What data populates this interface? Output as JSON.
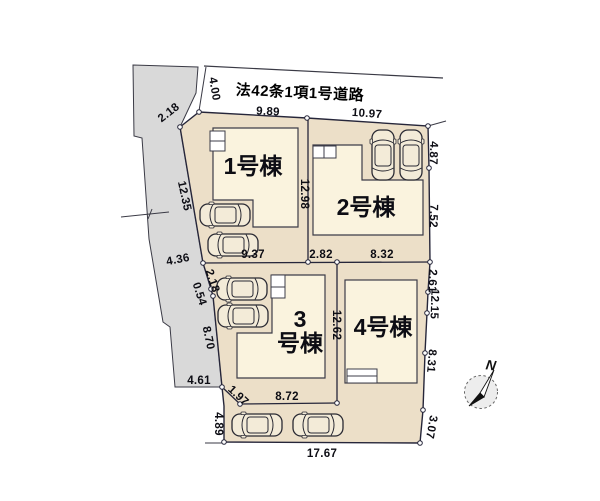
{
  "plan": {
    "road_label": "法42条1項1号道路",
    "compass": {
      "label": "N"
    },
    "buildings": [
      {
        "id": "1",
        "lines": [
          "1号棟"
        ],
        "x": 253,
        "y": 167
      },
      {
        "id": "2",
        "lines": [
          "2号棟"
        ],
        "x": 366,
        "y": 208
      },
      {
        "id": "3",
        "lines": [
          "3",
          "号棟"
        ],
        "x": 300,
        "y": 332
      },
      {
        "id": "4",
        "lines": [
          "4号棟"
        ],
        "x": 383,
        "y": 328
      }
    ],
    "dimensions": [
      {
        "value": "4.00",
        "x": 214,
        "y": 89,
        "rot": 80
      },
      {
        "value": "2.18",
        "x": 169,
        "y": 113,
        "rot": -38
      },
      {
        "value": "9.89",
        "x": 268,
        "y": 112,
        "rot": 3
      },
      {
        "value": "10.97",
        "x": 367,
        "y": 114,
        "rot": 4
      },
      {
        "value": "4.87",
        "x": 433,
        "y": 153,
        "rot": 92
      },
      {
        "value": "12.35",
        "x": 184,
        "y": 196,
        "rot": 78
      },
      {
        "value": "12.98",
        "x": 304,
        "y": 194,
        "rot": 90
      },
      {
        "value": "7.52",
        "x": 433,
        "y": 216,
        "rot": 92
      },
      {
        "value": "4.36",
        "x": 178,
        "y": 260,
        "rot": -11
      },
      {
        "value": "9.37",
        "x": 253,
        "y": 255,
        "rot": 0
      },
      {
        "value": "2.82",
        "x": 321,
        "y": 255,
        "rot": 0
      },
      {
        "value": "8.32",
        "x": 382,
        "y": 255,
        "rot": 0
      },
      {
        "value": "2.61",
        "x": 432,
        "y": 281,
        "rot": 92
      },
      {
        "value": "12.15",
        "x": 434,
        "y": 304,
        "rot": 92
      },
      {
        "value": "2.18",
        "x": 212,
        "y": 281,
        "rot": 72
      },
      {
        "value": "0.54",
        "x": 199,
        "y": 294,
        "rot": 72
      },
      {
        "value": "8.70",
        "x": 208,
        "y": 338,
        "rot": 78
      },
      {
        "value": "12.62",
        "x": 336,
        "y": 325,
        "rot": 90
      },
      {
        "value": "8.31",
        "x": 431,
        "y": 361,
        "rot": 95
      },
      {
        "value": "4.61",
        "x": 199,
        "y": 381,
        "rot": 0
      },
      {
        "value": "1.97",
        "x": 238,
        "y": 396,
        "rot": 43
      },
      {
        "value": "4.89",
        "x": 218,
        "y": 424,
        "rot": 90
      },
      {
        "value": "8.72",
        "x": 287,
        "y": 397,
        "rot": 0
      },
      {
        "value": "3.07",
        "x": 431,
        "y": 427,
        "rot": 100
      },
      {
        "value": "17.67",
        "x": 322,
        "y": 454,
        "rot": 0
      }
    ],
    "colors": {
      "lot_fill": "#ecdfc8",
      "building_fill": "#faf3de",
      "neighbor_fill": "#d9d9d9",
      "boundary_line": "#26263a"
    }
  }
}
